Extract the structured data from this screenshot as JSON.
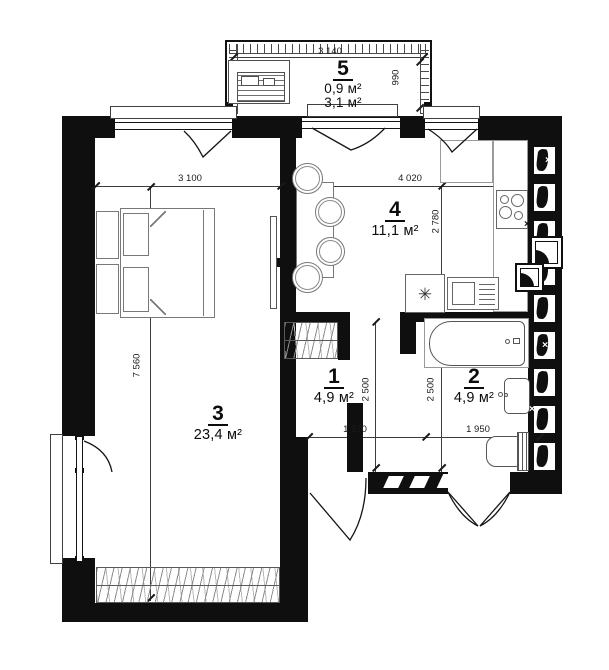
{
  "plan": {
    "title": "apartment-floor-plan",
    "rooms": {
      "r1": {
        "number": "1",
        "area": "4,9 м²"
      },
      "r2": {
        "number": "2",
        "area": "4,9 м²"
      },
      "r3": {
        "number": "3",
        "area": "23,4 м²"
      },
      "r4": {
        "number": "4",
        "area": "11,1 м²"
      },
      "r5": {
        "number": "5",
        "area_heated": "0,9 м²",
        "area_total": "3,1 м²"
      }
    },
    "dimensions": {
      "balcony_width": "3 140",
      "balcony_depth": "990",
      "bedroom_width": "3 100",
      "kitchen_width": "4 020",
      "kitchen_depth": "2 780",
      "left_height": "7 560",
      "hall_width": "1 970",
      "bath_width": "1 950",
      "hall_height": "2 500",
      "bath_height": "2 500"
    },
    "symbols": {
      "freezer": "✳",
      "vent_mark": "×"
    },
    "colors": {
      "wall": "#0f0f0f",
      "furniture_line": "#787878",
      "background": "#ffffff"
    }
  }
}
